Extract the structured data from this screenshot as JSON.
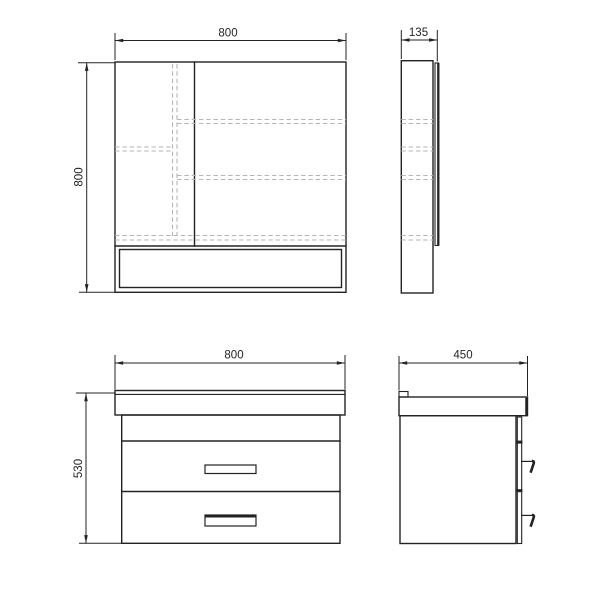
{
  "palette": {
    "line": "#232323",
    "dashed": "#b5b5b5",
    "background": "#ffffff"
  },
  "views": {
    "mirror_front": {
      "width_label": "800",
      "height_label": "800"
    },
    "mirror_side": {
      "depth_label": "135"
    },
    "vanity_front": {
      "width_label": "800",
      "height_label": "530"
    },
    "vanity_side": {
      "depth_label": "450"
    }
  }
}
